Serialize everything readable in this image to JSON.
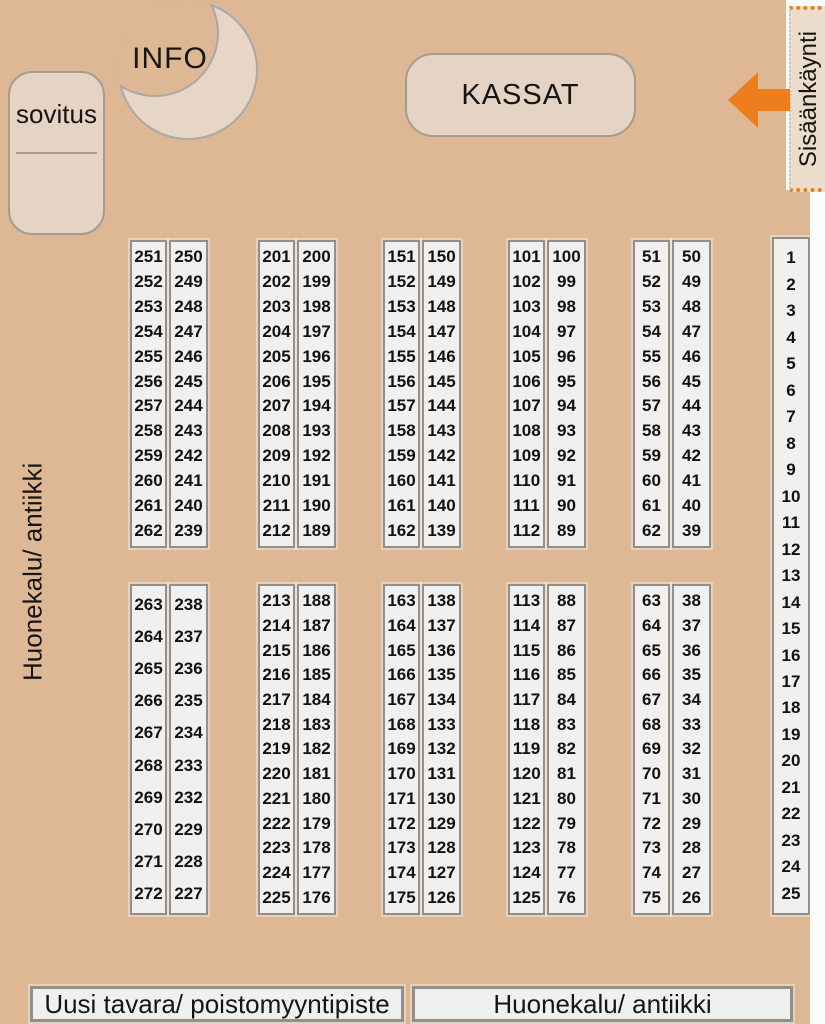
{
  "map": {
    "fitting_room_label": "sovitus",
    "info_label": "INFO",
    "checkout_label": "KASSAT",
    "entrance_label": "Sisäänkäynti",
    "left_area_label": "Huonekalu/ antiikki",
    "bottom_labels": [
      "Uusi tavara/ poistomyyntipiste",
      "Huonekalu/ antiikki"
    ]
  },
  "colors": {
    "background_tan": "#deb894",
    "light_box": "#e5d4c4",
    "strip_fill": "#f0f0ee",
    "strip_border": "#8f8f8f",
    "accent_orange": "#e87d1b",
    "text": "#151515"
  },
  "blocks": [
    {
      "left": [
        251,
        252,
        253,
        254,
        255,
        256,
        257,
        258,
        259,
        260,
        261,
        262
      ],
      "right": [
        250,
        249,
        248,
        247,
        246,
        245,
        244,
        243,
        242,
        241,
        240,
        239
      ]
    },
    {
      "left": [
        201,
        202,
        203,
        204,
        205,
        206,
        207,
        208,
        209,
        210,
        211,
        212
      ],
      "right": [
        200,
        199,
        198,
        197,
        196,
        195,
        194,
        193,
        192,
        191,
        190,
        189
      ]
    },
    {
      "left": [
        151,
        152,
        153,
        154,
        155,
        156,
        157,
        158,
        159,
        160,
        161,
        162
      ],
      "right": [
        150,
        149,
        148,
        147,
        146,
        145,
        144,
        143,
        142,
        141,
        140,
        139
      ]
    },
    {
      "left": [
        101,
        102,
        103,
        104,
        105,
        106,
        107,
        108,
        109,
        110,
        111,
        112
      ],
      "right": [
        100,
        99,
        98,
        97,
        96,
        95,
        94,
        93,
        92,
        91,
        90,
        89
      ]
    },
    {
      "left": [
        51,
        52,
        53,
        54,
        55,
        56,
        57,
        58,
        59,
        60,
        61,
        62
      ],
      "right": [
        50,
        49,
        48,
        47,
        46,
        45,
        44,
        43,
        42,
        41,
        40,
        39
      ]
    },
    {
      "left": [
        263,
        264,
        265,
        266,
        267,
        268,
        269,
        270,
        271,
        272
      ],
      "right": [
        238,
        237,
        236,
        235,
        234,
        233,
        232,
        229,
        228,
        227
      ]
    },
    {
      "left": [
        213,
        214,
        215,
        216,
        217,
        218,
        219,
        220,
        221,
        222,
        223,
        224,
        225
      ],
      "right": [
        188,
        187,
        186,
        185,
        184,
        183,
        182,
        181,
        180,
        179,
        178,
        177,
        176
      ]
    },
    {
      "left": [
        163,
        164,
        165,
        166,
        167,
        168,
        169,
        170,
        171,
        172,
        173,
        174,
        175
      ],
      "right": [
        138,
        137,
        136,
        135,
        134,
        133,
        132,
        131,
        130,
        129,
        128,
        127,
        126
      ]
    },
    {
      "left": [
        113,
        114,
        115,
        116,
        117,
        118,
        119,
        120,
        121,
        122,
        123,
        124,
        125
      ],
      "right": [
        88,
        87,
        86,
        85,
        84,
        83,
        82,
        81,
        80,
        79,
        78,
        77,
        76
      ]
    },
    {
      "left": [
        63,
        64,
        65,
        66,
        67,
        68,
        69,
        70,
        71,
        72,
        73,
        74,
        75
      ],
      "right": [
        38,
        37,
        36,
        35,
        34,
        33,
        32,
        31,
        30,
        29,
        28,
        27,
        26
      ]
    }
  ],
  "side_column": [
    1,
    2,
    3,
    4,
    5,
    6,
    7,
    8,
    9,
    10,
    11,
    12,
    13,
    14,
    15,
    16,
    17,
    18,
    19,
    20,
    21,
    22,
    23,
    24,
    25
  ]
}
